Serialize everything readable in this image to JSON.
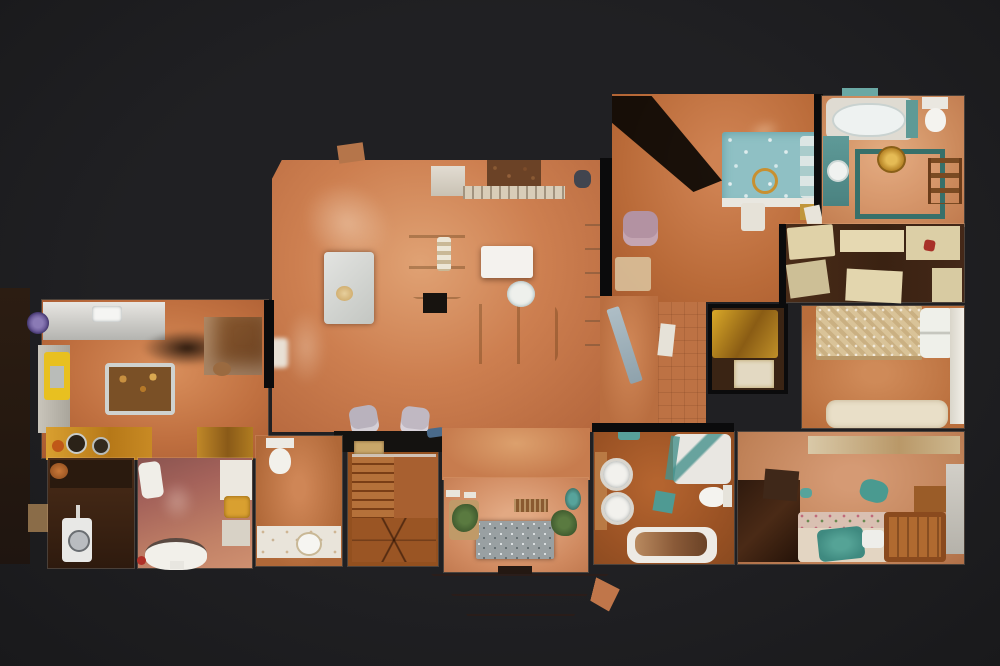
{
  "scene": {
    "kind": "3d-dollhouse-floorplan-top-view",
    "storeys_visible": 1,
    "background": "dark studio backdrop, no text or UI chrome visible"
  },
  "palette": {
    "bg": "#202023",
    "wall": "#0b0b0c",
    "terracotta": "#c07142",
    "terracotta_light": "#dca06d",
    "pink_tile": "#d59677",
    "bath_brown": "#9a5224",
    "mauve_floor": "#a4625a",
    "stair_wood": "#a05a28",
    "dark_wood": "#3a2113",
    "sofa_yellow": "#d79e32",
    "bed_teal": "#8fc0c4",
    "lace_bedspread": "#d9c398",
    "wardrobe_cream": "#e2d4ac",
    "fixture_white": "#f2f0ec",
    "brass_gold": "#c89030",
    "armchair_grey": "#b9b2bd",
    "plant_green": "#4e6b3a",
    "rug_grey": "#99a0a2",
    "fixture_teal": "#5f9a96",
    "accent_red": "#a83028"
  },
  "rooms": {
    "living_room": {
      "label": "Living room",
      "furniture": [
        "yellow loveseat",
        "yellow three-seater sofa",
        "white coffee table",
        "round side table",
        "dining table",
        "fireplace",
        "wall shelving",
        "two grey armchairs",
        "black console table"
      ]
    },
    "kitchen": {
      "label": "Kitchen",
      "furniture": [
        "steel worktop",
        "kitchen island",
        "yellow bench",
        "wooden dresser",
        "stove counter with pans"
      ]
    },
    "stair_hall": {
      "label": "Staircase",
      "furniture": [
        "winder staircase",
        "white banister"
      ]
    },
    "hallway": {
      "label": "Hallway",
      "furniture": []
    },
    "entry_hall": {
      "label": "Entrance hall",
      "furniture": [
        "speckled doormat",
        "brown door mat",
        "two potted plants"
      ]
    },
    "porch": {
      "label": "Entrance steps",
      "furniture": [
        "stone steps"
      ]
    },
    "master_bedroom": {
      "label": "Master bedroom",
      "furniture": [
        "double bed with teal floral cover",
        "mauve armchair",
        "beige rug",
        "blanket chest",
        "gold bedside table"
      ]
    },
    "ensuite_bathroom": {
      "label": "En-suite bathroom",
      "furniture": [
        "bathtub",
        "toilet",
        "teal vanity with round basin",
        "towel ladder",
        "brass stool",
        "green tiled border"
      ]
    },
    "dressing_area": {
      "label": "Dressing area",
      "furniture": [
        "cream wardrobes",
        "red bag"
      ]
    },
    "corridor": {
      "label": "Corridor",
      "furniture": [
        "open mirrored door",
        "white door leaf"
      ]
    },
    "closet": {
      "label": "Closet",
      "furniture": [
        "gold wardrobe"
      ]
    },
    "bedroom_2": {
      "label": "Bedroom 2",
      "furniture": [
        "double bed with lace cover",
        "white pillows",
        "white headboard panel",
        "upholstered cream bench"
      ]
    },
    "bedroom_3": {
      "label": "Bedroom 3",
      "furniture": [
        "floral sofa with teal throw",
        "dark wardrobe",
        "wooden bed frame",
        "desk shelf",
        "wood cabinet"
      ]
    },
    "family_bathroom": {
      "label": "Family bathroom",
      "furniture": [
        "two round basins",
        "corner shower",
        "toilet",
        "bathtub",
        "teal bath mat"
      ]
    },
    "guest_toilet": {
      "label": "Guest toilet",
      "furniture": [
        "toilet",
        "vanity counter with bowl basin"
      ]
    },
    "second_bathroom": {
      "label": "Bathroom",
      "furniture": [
        "pedestal basin",
        "oval bathtub",
        "cabinet with gold towels"
      ]
    },
    "utility_room": {
      "label": "Utility room",
      "furniture": [
        "washing machine",
        "dark cabinet"
      ]
    }
  }
}
